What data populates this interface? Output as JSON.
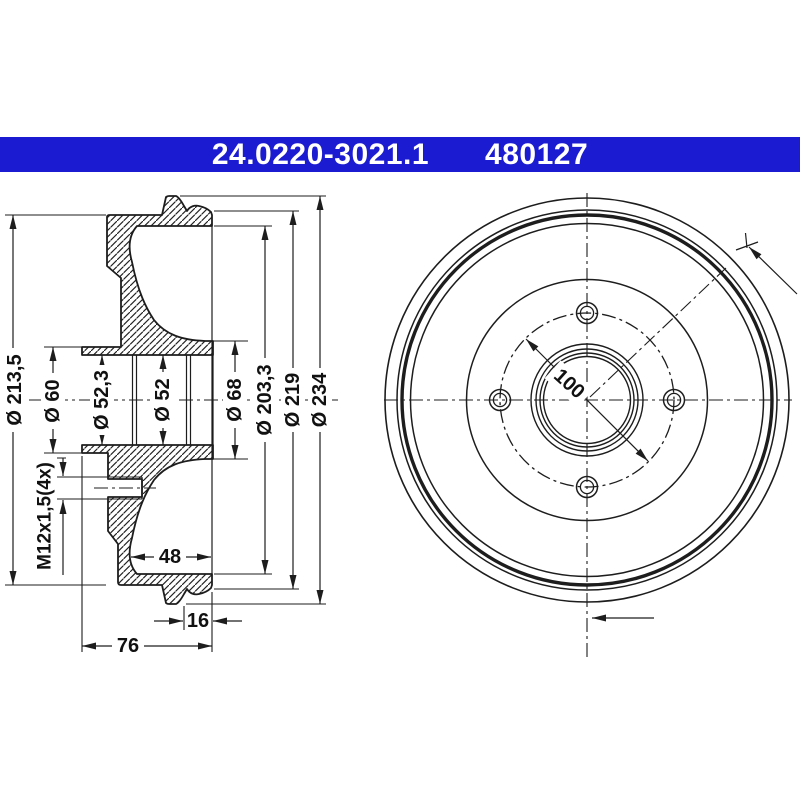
{
  "title_bar": {
    "part_number": "24.0220-3021.1",
    "reference_number": "480127",
    "background_color": "#1b1bd2",
    "text_color": "#ffffff"
  },
  "section_view": {
    "diameter_213_5": "Ø 213,5",
    "diameter_60": "Ø 60",
    "diameter_52_3": "Ø 52,3",
    "diameter_52": "Ø 52",
    "diameter_68": "Ø 68",
    "diameter_203_3": "Ø 203,3",
    "diameter_219": "Ø 219",
    "diameter_234": "Ø 234",
    "thread_spec": "M12x1,5(4x)",
    "depth_48": "48",
    "depth_16": "16",
    "depth_76": "76"
  },
  "front_view": {
    "bolt_circle_diameter": "100"
  },
  "drawing": {
    "line_color": "#1d1d1d",
    "background_color": "#ffffff"
  }
}
